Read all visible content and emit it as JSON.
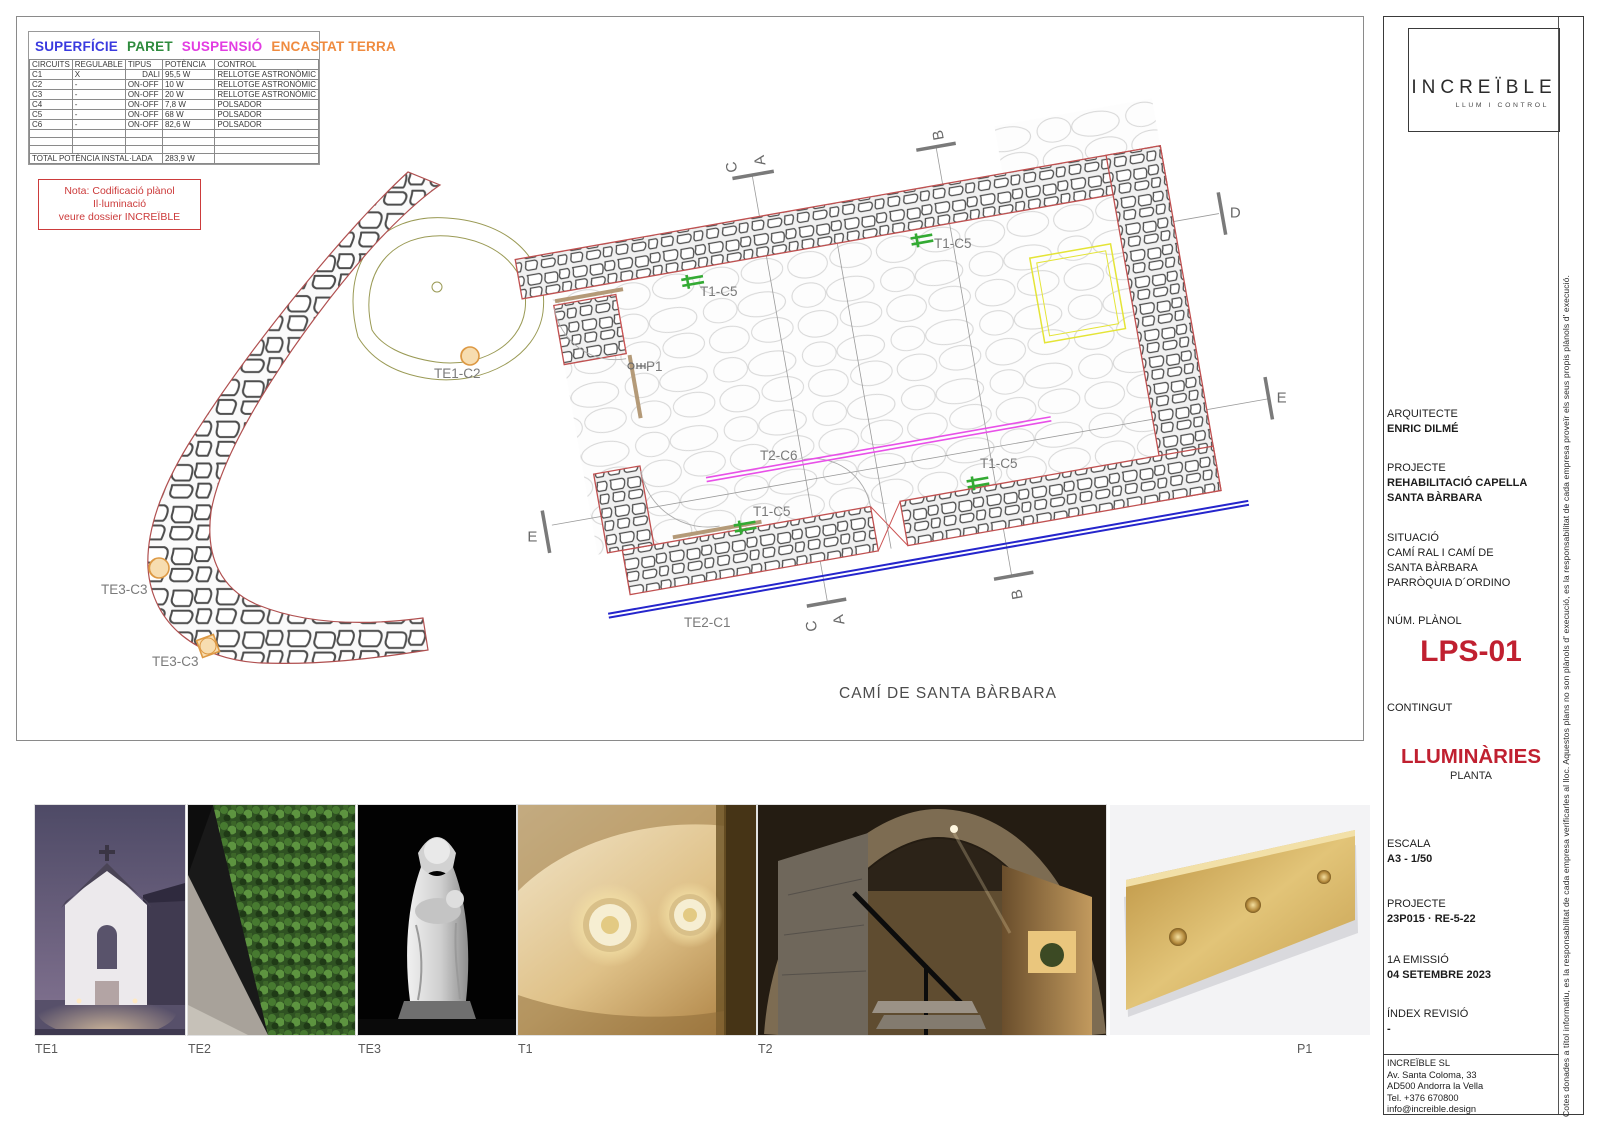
{
  "colors": {
    "surface_blue": "#3a3adf",
    "wall_green": "#2e8b3d",
    "suspension_magenta": "#e23ce2",
    "recessed_orange": "#ef8b3f",
    "accent_red": "#c02030",
    "plan_outline_red": "#c05050",
    "plan_line_blue": "#2525cc",
    "plan_line_magenta": "#e850e8",
    "plan_symbol_green": "#33aa33",
    "plan_rect_yellow": "#e4e436",
    "plan_symbol_orange": "#dd9944"
  },
  "legend": {
    "mount_types": [
      {
        "label": "SUPERFÍCIE"
      },
      {
        "label": "PARET"
      },
      {
        "label": "SUSPENSIÓ"
      },
      {
        "label": "ENCASTAT TERRA"
      }
    ],
    "table": {
      "headers": [
        "CIRCUITS",
        "REGULABLE",
        "TIPUS",
        "POTÈNCIA",
        "CONTROL"
      ],
      "rows": [
        [
          "C1",
          "X",
          "DALI",
          "95,5 W",
          "RELLOTGE ASTRONÒMIC"
        ],
        [
          "C2",
          "-",
          "ON-OFF",
          "10 W",
          "RELLOTGE ASTRONÒMIC"
        ],
        [
          "C3",
          "-",
          "ON-OFF",
          "20 W",
          "RELLOTGE ASTRONÒMIC"
        ],
        [
          "C4",
          "-",
          "ON-OFF",
          "7,8 W",
          "POLSADOR"
        ],
        [
          "C5",
          "-",
          "ON-OFF",
          "68 W",
          "POLSADOR"
        ],
        [
          "C6",
          "-",
          "ON-OFF",
          "82,6 W",
          "POLSADOR"
        ]
      ],
      "total_label": "TOTAL POTÈNCIA INSTAL·LADA",
      "total_value": "283,9 W"
    },
    "note_line1": "Nota: Codificació plànol Il·luminació",
    "note_line2": "veure dossier INCREÏBLE"
  },
  "plan": {
    "street_label": "CAMÍ DE SANTA BÀRBARA",
    "labels": {
      "t1c5": "T1-C5",
      "t2c6": "T2-C6",
      "te1c2": "TE1-C2",
      "te2c1": "TE2-C1",
      "te3c3": "TE3-C3",
      "p1": "P1"
    },
    "sections": {
      "a": "A",
      "b": "B",
      "c": "C",
      "d": "D",
      "e": "E"
    }
  },
  "photos": [
    {
      "label": "TE1"
    },
    {
      "label": "TE2"
    },
    {
      "label": "TE3"
    },
    {
      "label": "T1"
    },
    {
      "label": "T2"
    },
    {
      "label": "P1"
    }
  ],
  "titleblock": {
    "logo": "INCREÏBLE",
    "logo_tagline": "LLUM I CONTROL",
    "architect_label": "ARQUITECTE",
    "architect_value": "ENRIC DILMÉ",
    "project_label": "PROJECTE",
    "project_value_line1": "REHABILITACIÓ CAPELLA",
    "project_value_line2": "SANTA BÀRBARA",
    "situation_label": "SITUACIÓ",
    "situation_line1": "CAMÍ RAL I CAMÍ DE",
    "situation_line2": "SANTA BÀRBARA",
    "situation_line3": "PARRÒQUIA D´ORDINO",
    "plan_number_label": "NÚM. PLÀNOL",
    "plan_number_value": "LPS-01",
    "content_label": "CONTINGUT",
    "content_value": "LLUMINÀRIES",
    "content_sub": "PLANTA",
    "scale_label": "ESCALA",
    "scale_value": "A3 - 1/50",
    "project_code_label": "PROJECTE",
    "project_code_value": "23P015 · RE-5-22",
    "emission_label": "1A EMISSIÓ",
    "emission_value": "04 SETEMBRE 2023",
    "revision_label": "ÍNDEX REVISIÓ",
    "revision_value": "-",
    "company_name": "INCREÏBLE SL",
    "company_address1": "Av. Santa Coloma, 33",
    "company_address2": "AD500 Andorra la Vella",
    "company_phone": "Tel. +376 670800",
    "company_email": "info@increible.design",
    "disclaimer": "Cotes donades a títol informatiu, es la responsabilitat de cada empresa verificarles al lloc. Aquestos plans no son plànols d' execució, es la responsabilitat de cada empresa proveïr els seus propis plànols d' execució."
  }
}
